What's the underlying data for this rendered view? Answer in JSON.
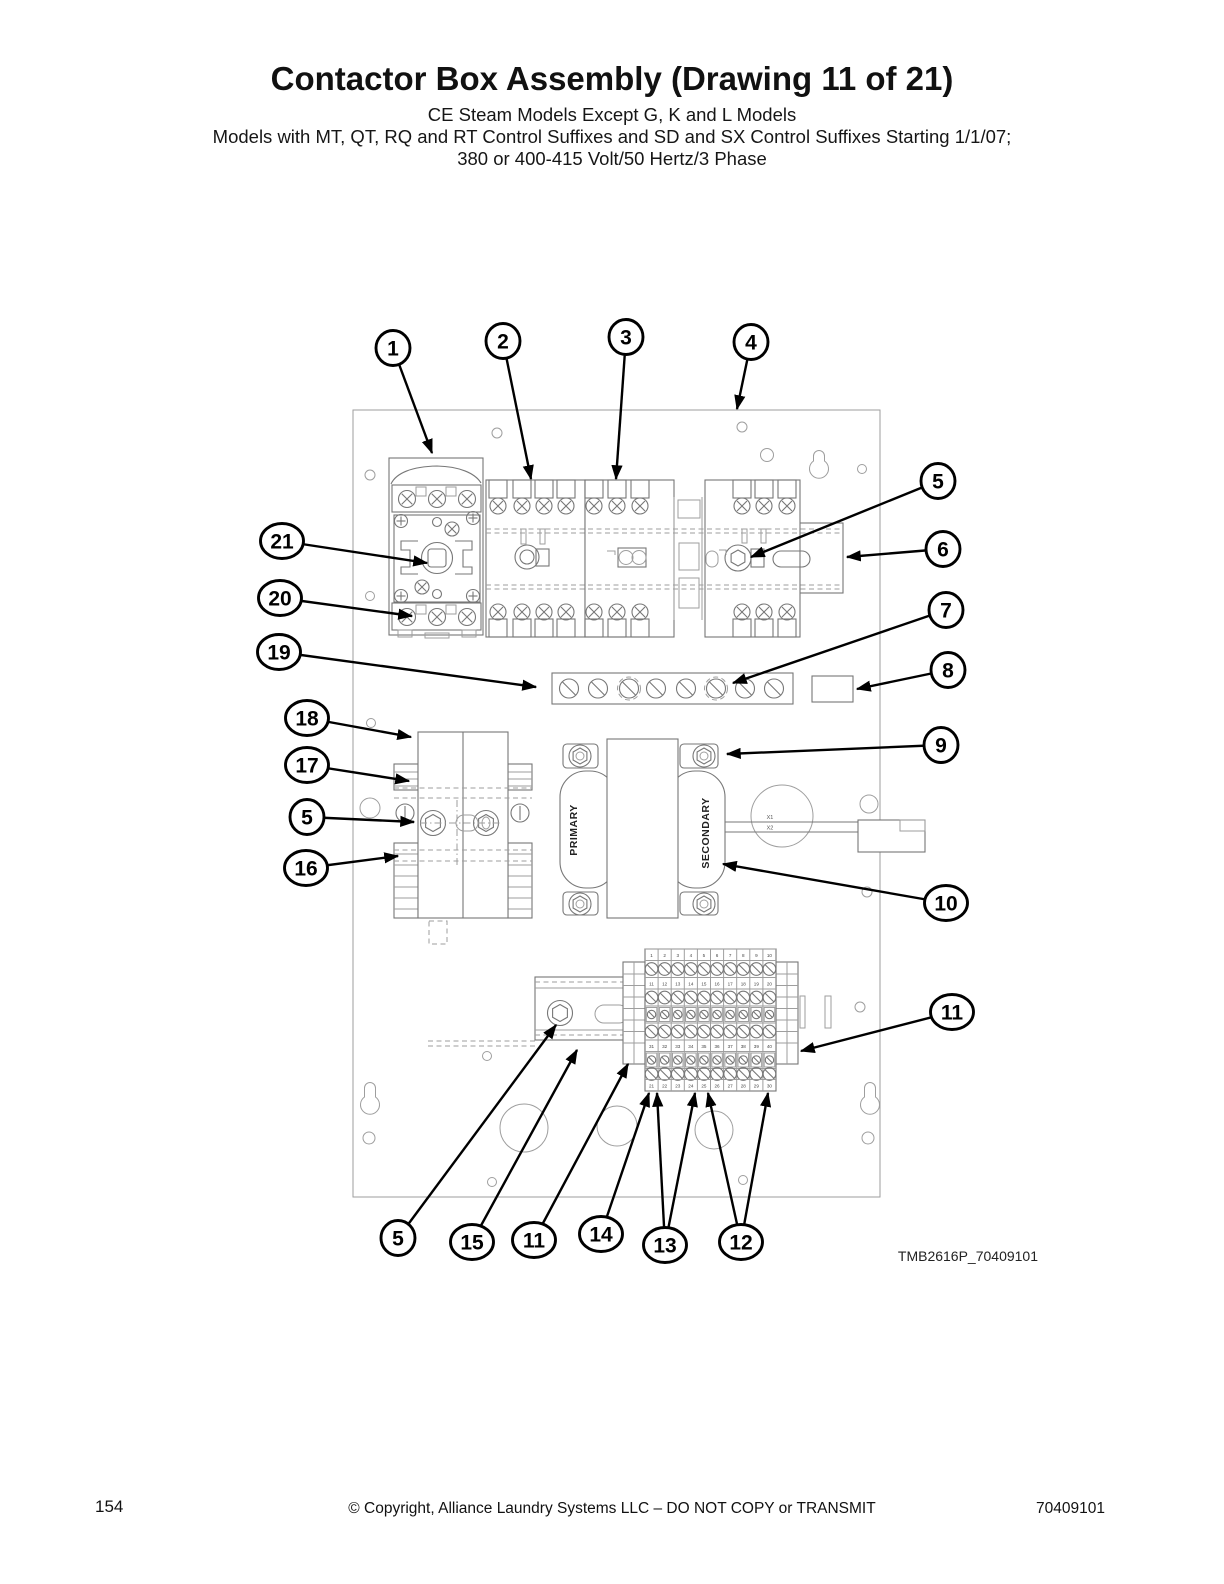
{
  "page": {
    "title": "Contactor Box Assembly (Drawing 11 of 21)",
    "subtitle_lines": [
      "CE Steam Models Except G, K and L Models",
      "Models with MT, QT, RQ and RT Control Suffixes and SD and SX Control Suffixes Starting 1/1/07;",
      "380 or 400-415 Volt/50 Hertz/3 Phase"
    ],
    "drawing_code": "TMB2616P_70409101",
    "footer": {
      "page_number": "154",
      "copyright": "© Copyright, Alliance Laundry Systems LLC – DO NOT COPY or TRANSMIT",
      "document_number": "70409101"
    }
  },
  "diagram": {
    "transformer": {
      "primary_label": "PRIMARY",
      "secondary_label": "SECONDARY",
      "wire_labels": [
        "X1",
        "X2"
      ]
    },
    "terminal_rows": [
      [
        1,
        2,
        3,
        4,
        5,
        6,
        7,
        8,
        9,
        10
      ],
      [
        11,
        12,
        13,
        14,
        15,
        16,
        17,
        18,
        19,
        20
      ],
      [
        31,
        32,
        33,
        34,
        35,
        36,
        37,
        38,
        39,
        40
      ],
      [
        21,
        22,
        23,
        24,
        25,
        26,
        27,
        28,
        29,
        30
      ]
    ],
    "callouts": [
      {
        "id": "1",
        "label": "1",
        "x": 393,
        "y": 348,
        "targets": [
          [
            432,
            453
          ]
        ]
      },
      {
        "id": "2",
        "label": "2",
        "x": 503,
        "y": 341,
        "targets": [
          [
            531,
            479
          ]
        ]
      },
      {
        "id": "3",
        "label": "3",
        "x": 626,
        "y": 337,
        "targets": [
          [
            616,
            479
          ]
        ]
      },
      {
        "id": "4",
        "label": "4",
        "x": 751,
        "y": 342,
        "targets": [
          [
            737,
            409
          ]
        ]
      },
      {
        "id": "5-din-top",
        "label": "5",
        "x": 938,
        "y": 481,
        "targets": [
          [
            751,
            557
          ]
        ]
      },
      {
        "id": "6",
        "label": "6",
        "x": 943,
        "y": 549,
        "targets": [
          [
            847,
            557
          ]
        ]
      },
      {
        "id": "7",
        "label": "7",
        "x": 946,
        "y": 610,
        "targets": [
          [
            733,
            683
          ]
        ]
      },
      {
        "id": "8",
        "label": "8",
        "x": 948,
        "y": 670,
        "targets": [
          [
            857,
            689
          ]
        ]
      },
      {
        "id": "9",
        "label": "9",
        "x": 941,
        "y": 745,
        "targets": [
          [
            727,
            754
          ]
        ]
      },
      {
        "id": "10",
        "label": "10",
        "x": 946,
        "y": 903,
        "targets": [
          [
            723,
            864
          ]
        ]
      },
      {
        "id": "11-right",
        "label": "11",
        "x": 952,
        "y": 1012,
        "targets": [
          [
            801,
            1051
          ]
        ]
      },
      {
        "id": "21",
        "label": "21",
        "x": 282,
        "y": 541,
        "targets": [
          [
            427,
            563
          ]
        ]
      },
      {
        "id": "20",
        "label": "20",
        "x": 280,
        "y": 598,
        "targets": [
          [
            412,
            616
          ]
        ]
      },
      {
        "id": "19",
        "label": "19",
        "x": 279,
        "y": 652,
        "targets": [
          [
            536,
            687
          ]
        ]
      },
      {
        "id": "18",
        "label": "18",
        "x": 307,
        "y": 718,
        "targets": [
          [
            411,
            737
          ]
        ]
      },
      {
        "id": "17",
        "label": "17",
        "x": 307,
        "y": 765,
        "targets": [
          [
            409,
            781
          ]
        ]
      },
      {
        "id": "5-fuse",
        "label": "5",
        "x": 307,
        "y": 817,
        "targets": [
          [
            414,
            822
          ]
        ]
      },
      {
        "id": "16",
        "label": "16",
        "x": 306,
        "y": 868,
        "targets": [
          [
            398,
            856
          ]
        ]
      },
      {
        "id": "5-bottom",
        "label": "5",
        "x": 398,
        "y": 1238,
        "targets": [
          [
            556,
            1025
          ]
        ]
      },
      {
        "id": "15",
        "label": "15",
        "x": 472,
        "y": 1242,
        "targets": [
          [
            577,
            1050
          ]
        ]
      },
      {
        "id": "11-bottom",
        "label": "11",
        "x": 534,
        "y": 1240,
        "targets": [
          [
            628,
            1064
          ]
        ]
      },
      {
        "id": "14",
        "label": "14",
        "x": 601,
        "y": 1234,
        "targets": [
          [
            649,
            1093
          ]
        ]
      },
      {
        "id": "13",
        "label": "13",
        "x": 665,
        "y": 1245,
        "targets": [
          [
            657,
            1093
          ],
          [
            695,
            1093
          ]
        ]
      },
      {
        "id": "12",
        "label": "12",
        "x": 741,
        "y": 1242,
        "targets": [
          [
            708,
            1093
          ],
          [
            768,
            1093
          ]
        ]
      }
    ]
  }
}
